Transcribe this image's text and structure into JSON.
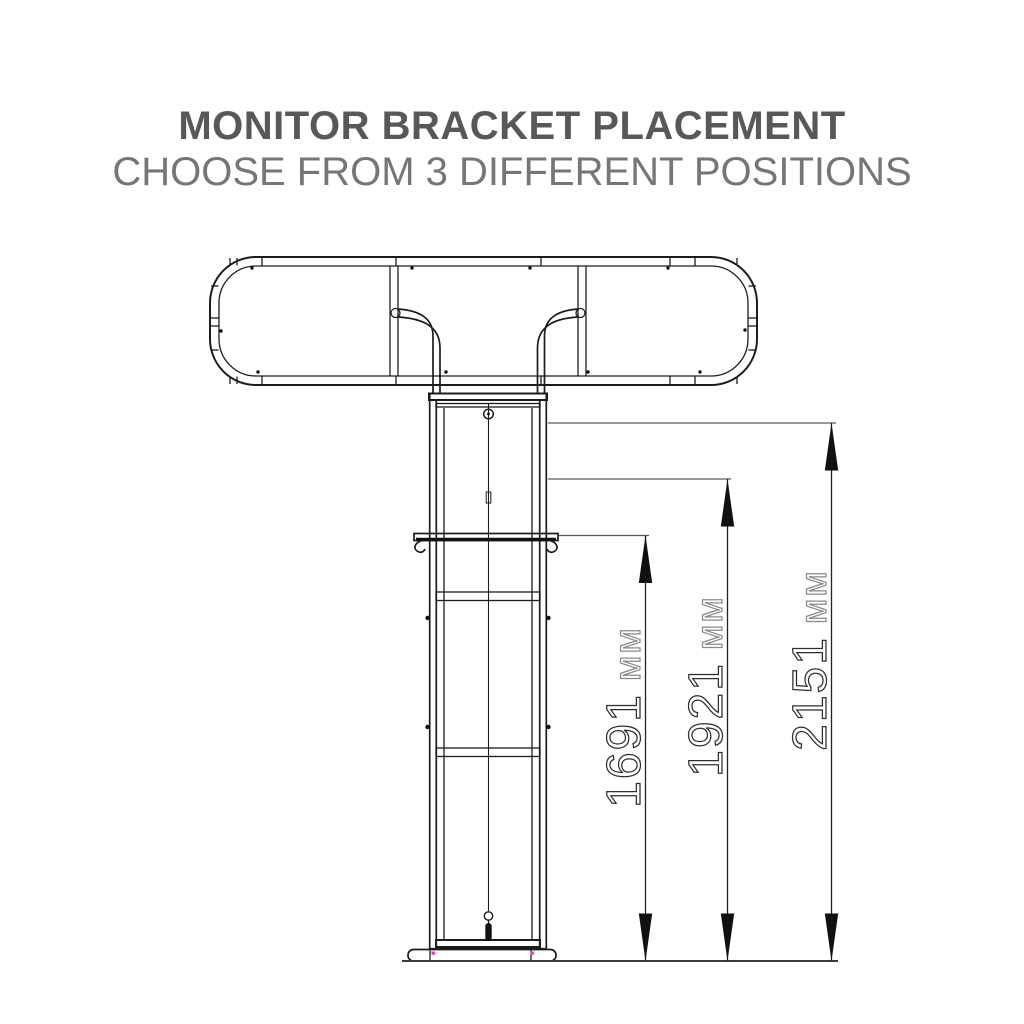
{
  "header": {
    "title": "MONITOR BRACKET PLACEMENT",
    "subtitle": "CHOOSE FROM 3 DIFFERENT POSITIONS"
  },
  "diagram": {
    "dimensions": [
      {
        "value": "1691",
        "unit": "мм"
      },
      {
        "value": "1921",
        "unit": "мм"
      },
      {
        "value": "2151",
        "unit": "мм"
      }
    ],
    "colors": {
      "title_text": "#57585a",
      "subtitle_text": "#757679",
      "line": "#1c1c1c",
      "extension_line": "#5a5a5a",
      "dimension_digits": "#2e2e2e",
      "dimension_unit": "#8a8a8a",
      "base_accent_dots": "#e83bd0"
    }
  }
}
